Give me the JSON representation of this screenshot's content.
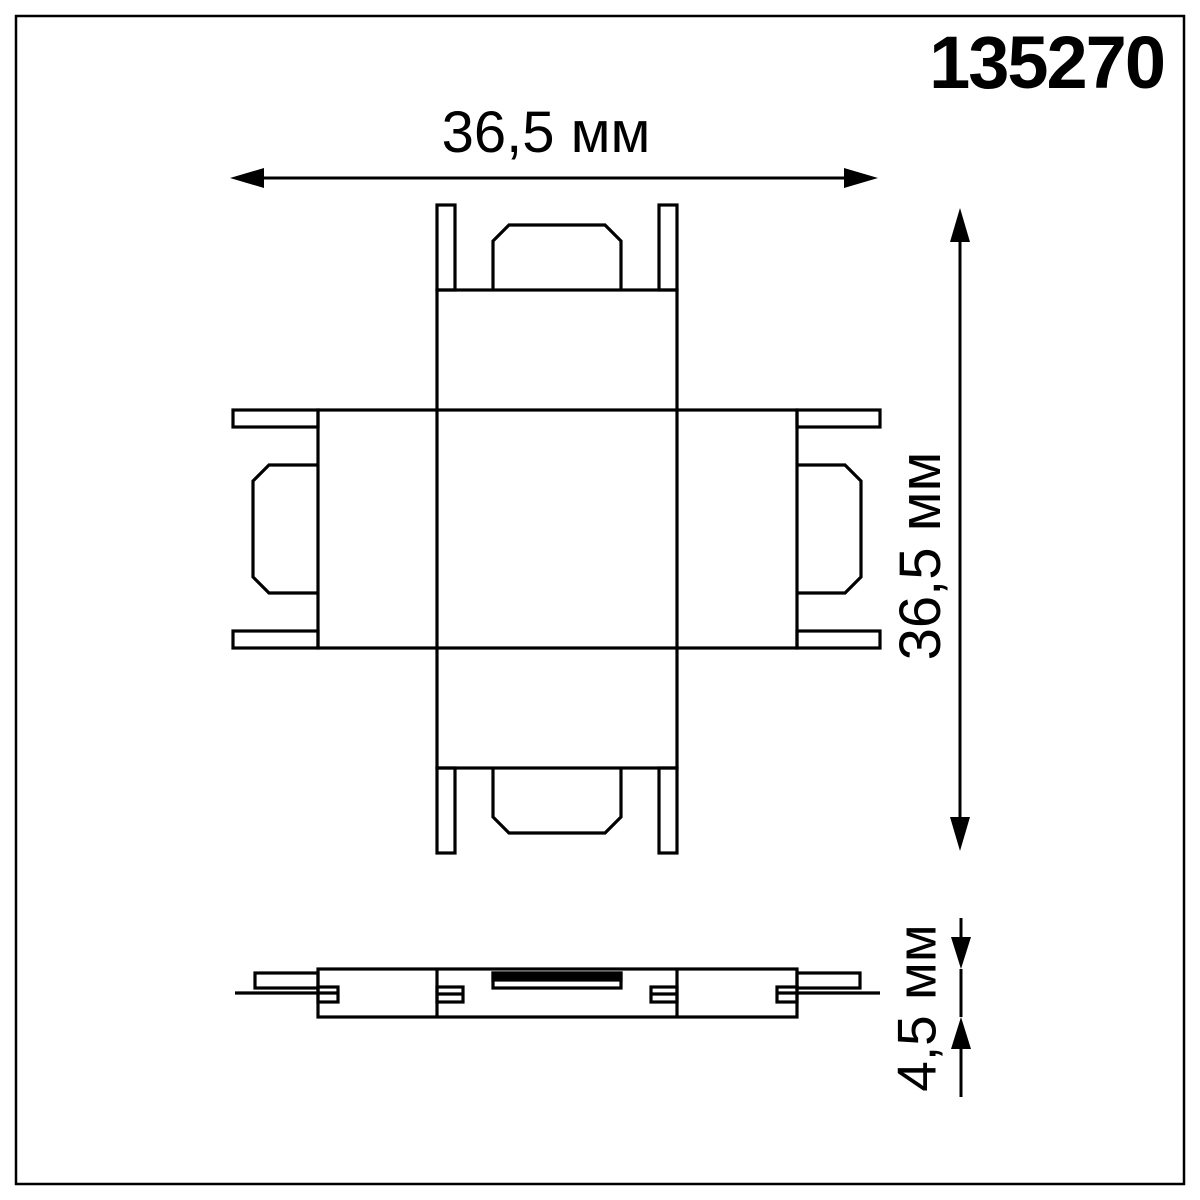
{
  "page": {
    "background": "#ffffff",
    "line_color": "#000000",
    "frame": "thin black border inset around sheet"
  },
  "title_block": {
    "part_number": "135270"
  },
  "dimensions": {
    "width": "36,5 мм",
    "height": "36,5 мм",
    "thickness": "4,5 мм"
  },
  "views": {
    "plan_view": {
      "description": "X-shaped (cross) track connector seen from top, four arms each with two corner tabs and a chamfered center plug",
      "width_label": "36,5 мм",
      "height_label": "36,5 мм"
    },
    "side_view": {
      "description": "thin side profile aligned under plan view with end tabs, center track lines and top strip",
      "thickness_label": "4,5 мм"
    }
  }
}
